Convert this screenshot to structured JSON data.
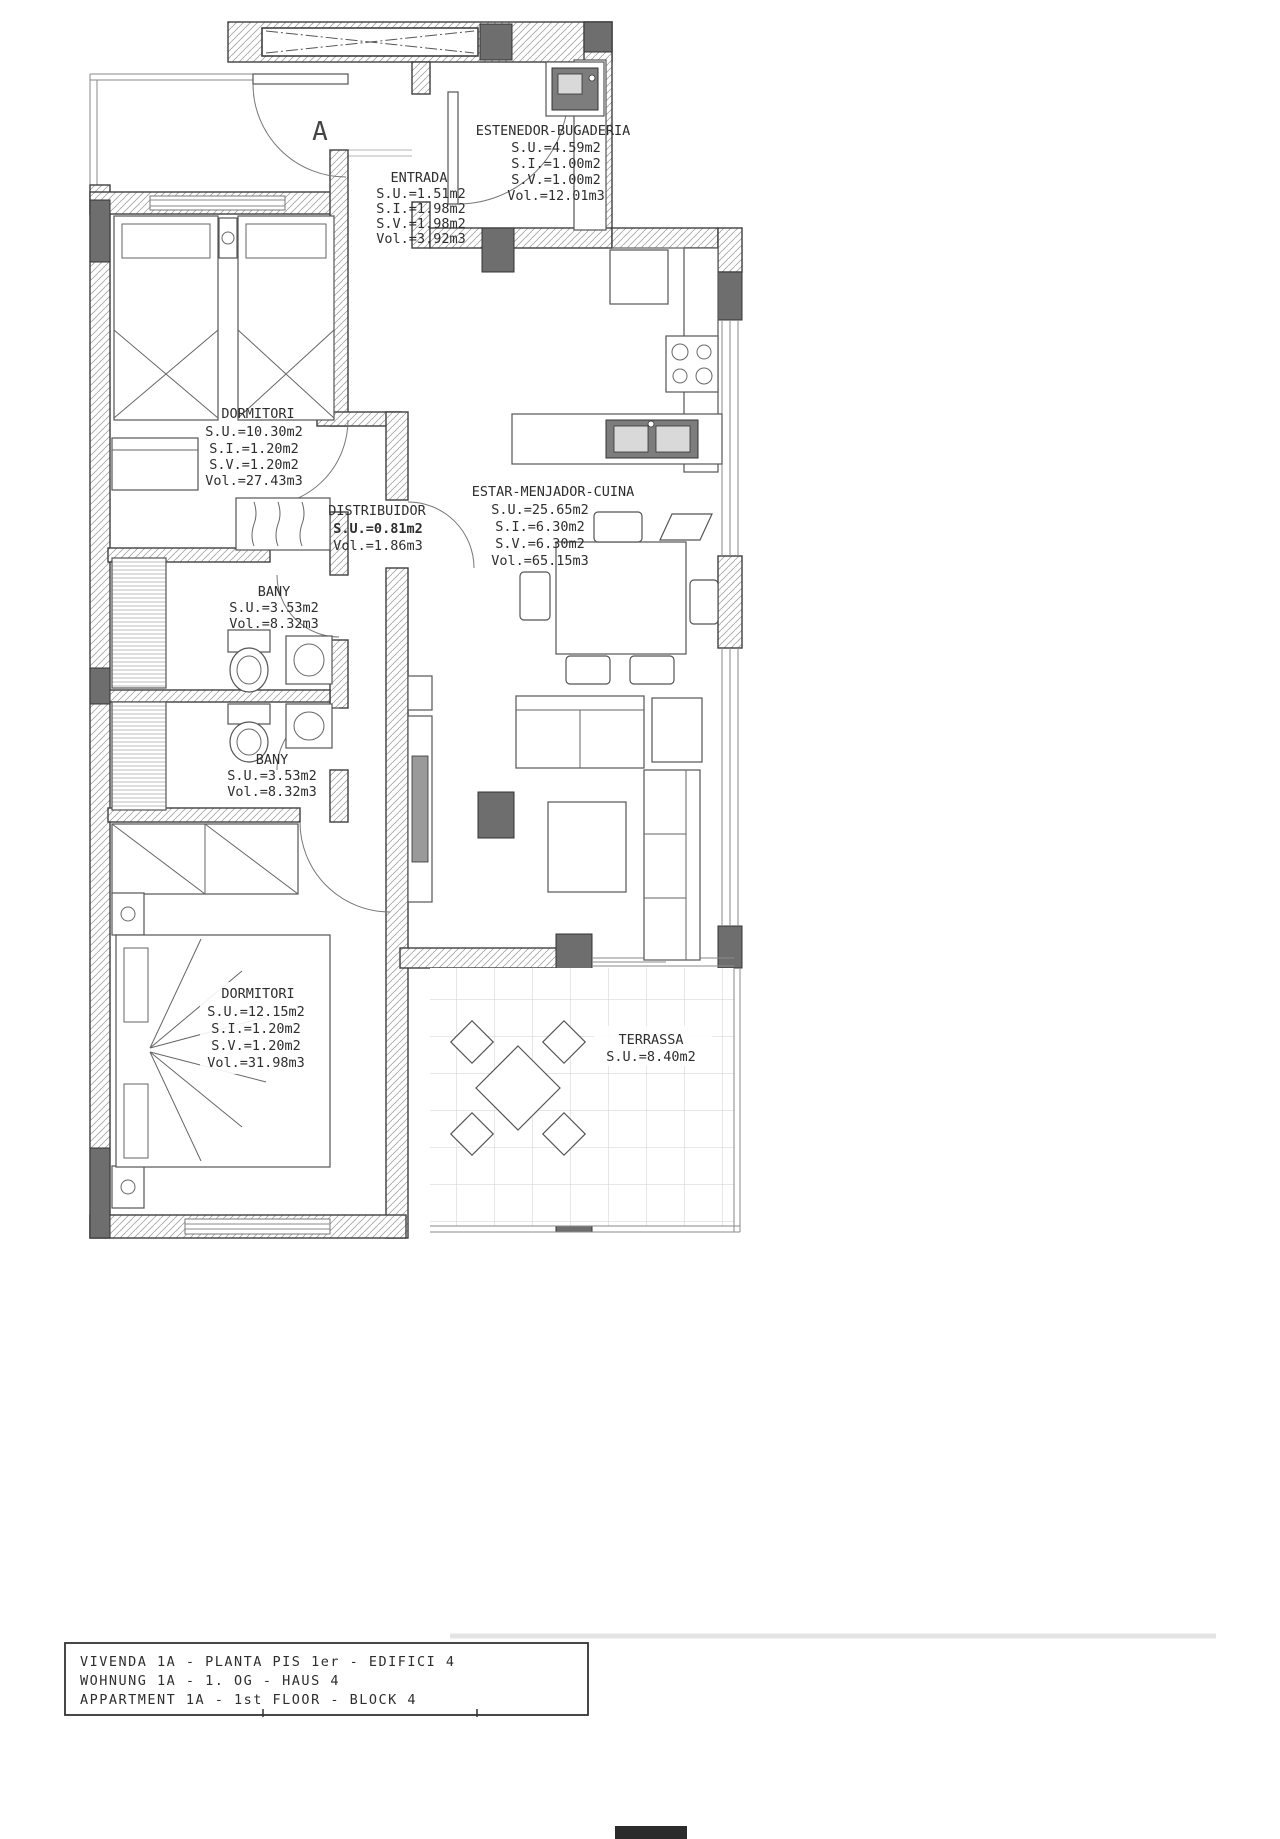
{
  "drawing": {
    "section_marker": "A",
    "rooms": [
      {
        "id": "estenedor",
        "name": "ESTENEDOR-BUGADERIA",
        "su": "S.U.=4.59m2",
        "si": "S.I.=1.00m2",
        "sv": "S.V.=1.00m2",
        "vol": "Vol.=12.01m3"
      },
      {
        "id": "entrada",
        "name": "ENTRADA",
        "su": "S.U.=1.51m2",
        "si": "S.I.=1.98m2",
        "sv": "S.V.=1.98m2",
        "vol": "Vol.=3.92m3"
      },
      {
        "id": "dormitori-1",
        "name": "DORMITORI",
        "su": "S.U.=10.30m2",
        "si": "S.I.=1.20m2",
        "sv": "S.V.=1.20m2",
        "vol": "Vol.=27.43m3"
      },
      {
        "id": "distribuidor",
        "name": "DISTRIBUIDOR",
        "su": "S.U.=0.81m2",
        "vol": "Vol.=1.86m3"
      },
      {
        "id": "estar-menjador-cuina",
        "name": "ESTAR-MENJADOR-CUINA",
        "su": "S.U.=25.65m2",
        "si": "S.I.=6.30m2",
        "sv": "S.V.=6.30m2",
        "vol": "Vol.=65.15m3"
      },
      {
        "id": "bany-1",
        "name": "BANY",
        "su": "S.U.=3.53m2",
        "vol": "Vol.=8.32m3"
      },
      {
        "id": "bany-2",
        "name": "BANY",
        "su": "S.U.=3.53m2",
        "vol": "Vol.=8.32m3"
      },
      {
        "id": "dormitori-2",
        "name": "DORMITORI",
        "su": "S.U.=12.15m2",
        "si": "S.I.=1.20m2",
        "sv": "S.V.=1.20m2",
        "vol": "Vol.=31.98m3"
      },
      {
        "id": "terrassa",
        "name": "TERRASSA",
        "su": "S.U.=8.40m2"
      }
    ],
    "title_block": {
      "line1": "VIVENDA 1A - PLANTA PIS 1er - EDIFICI 4",
      "line2": "WOHNUNG 1A - 1. OG - HAUS 4",
      "line3": "APPARTMENT 1A - 1st FLOOR - BLOCK 4"
    },
    "colors": {
      "line": "#3f3f3f",
      "pillar": "#6e6e6e",
      "hatch": "#a5a5a5",
      "tile": "#cfcfcf"
    }
  }
}
